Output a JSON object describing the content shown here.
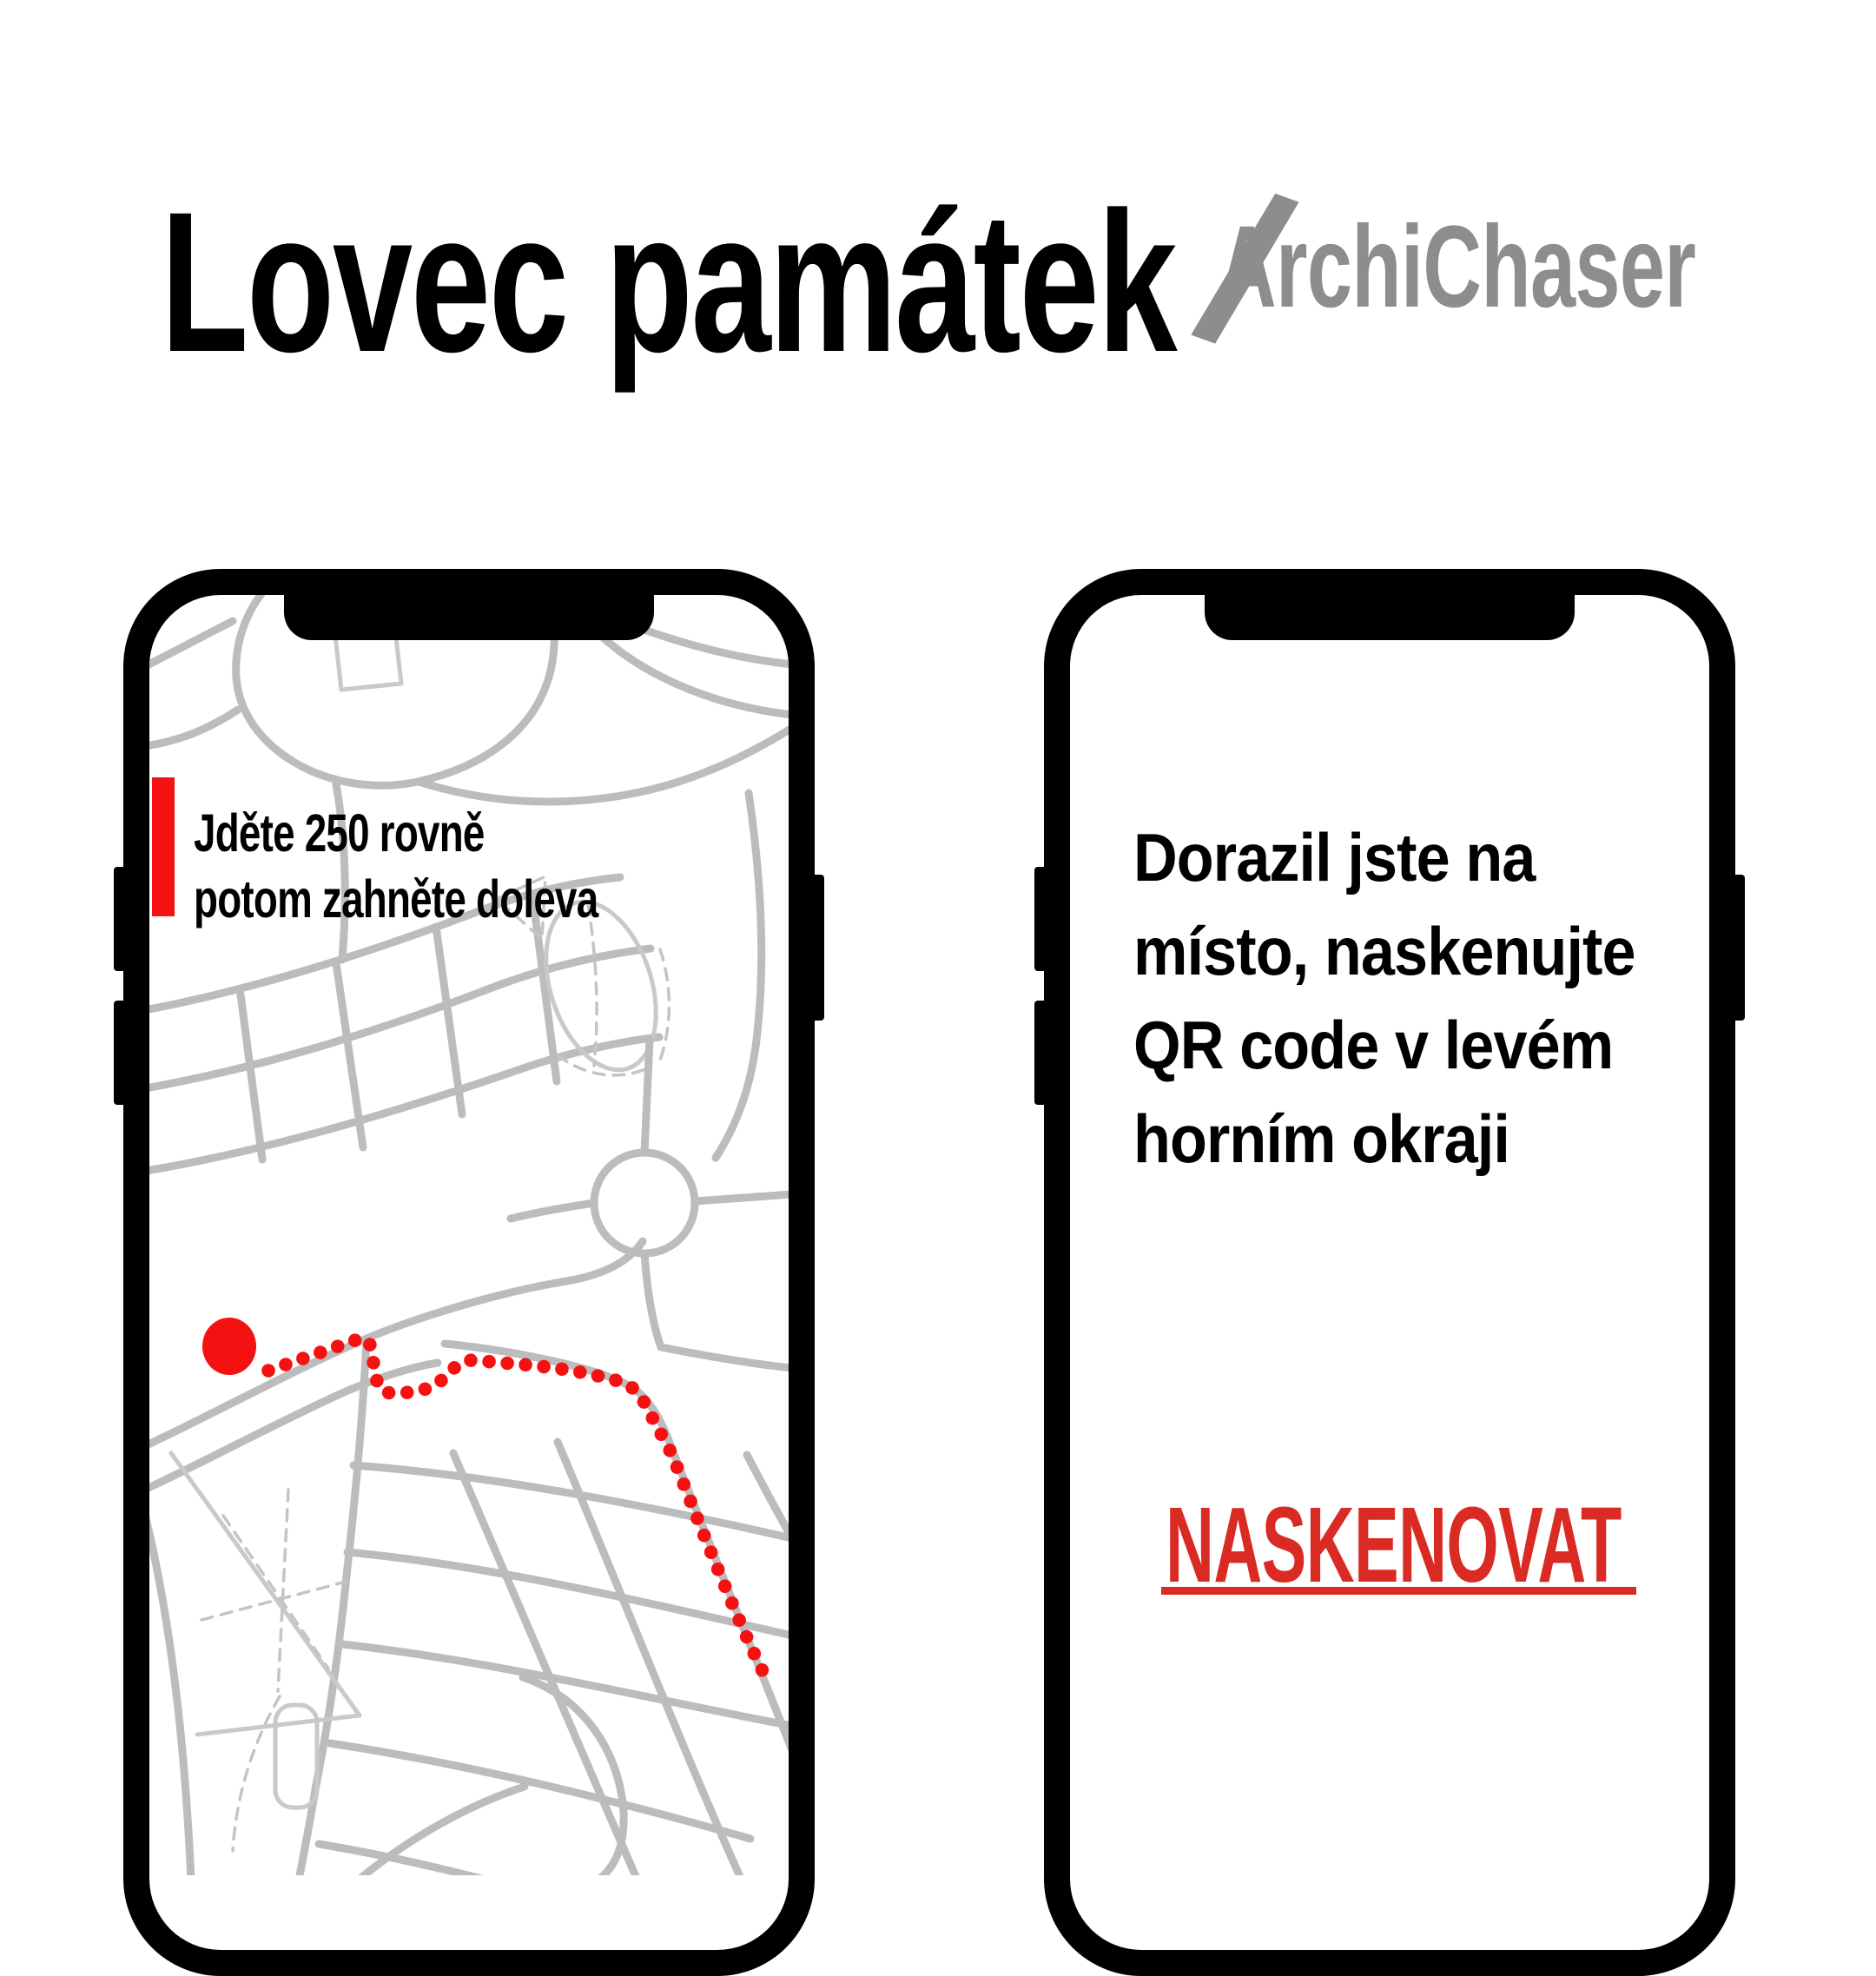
{
  "header": {
    "title": "Lovec památek",
    "separator": "/",
    "subtitle": "ArchiChaser"
  },
  "left_phone": {
    "instruction": {
      "line1": "Jděte 250 rovně",
      "line2": "potom zahněte doleva"
    },
    "map": {
      "marker": "current-location-red-dot",
      "route_style": "red-dotted-path"
    }
  },
  "right_phone": {
    "message": {
      "line1": "Dorazil jste na",
      "line2": "místo, naskenujte",
      "line3": "QR code v levém",
      "line4": "horním okraji"
    },
    "link_label": "NASKENOVAT"
  },
  "colors": {
    "accent_red": "#f51111",
    "link_red": "#d92b24",
    "subtitle_gray": "#8d8d8d",
    "road_gray": "#bcbcbc"
  }
}
